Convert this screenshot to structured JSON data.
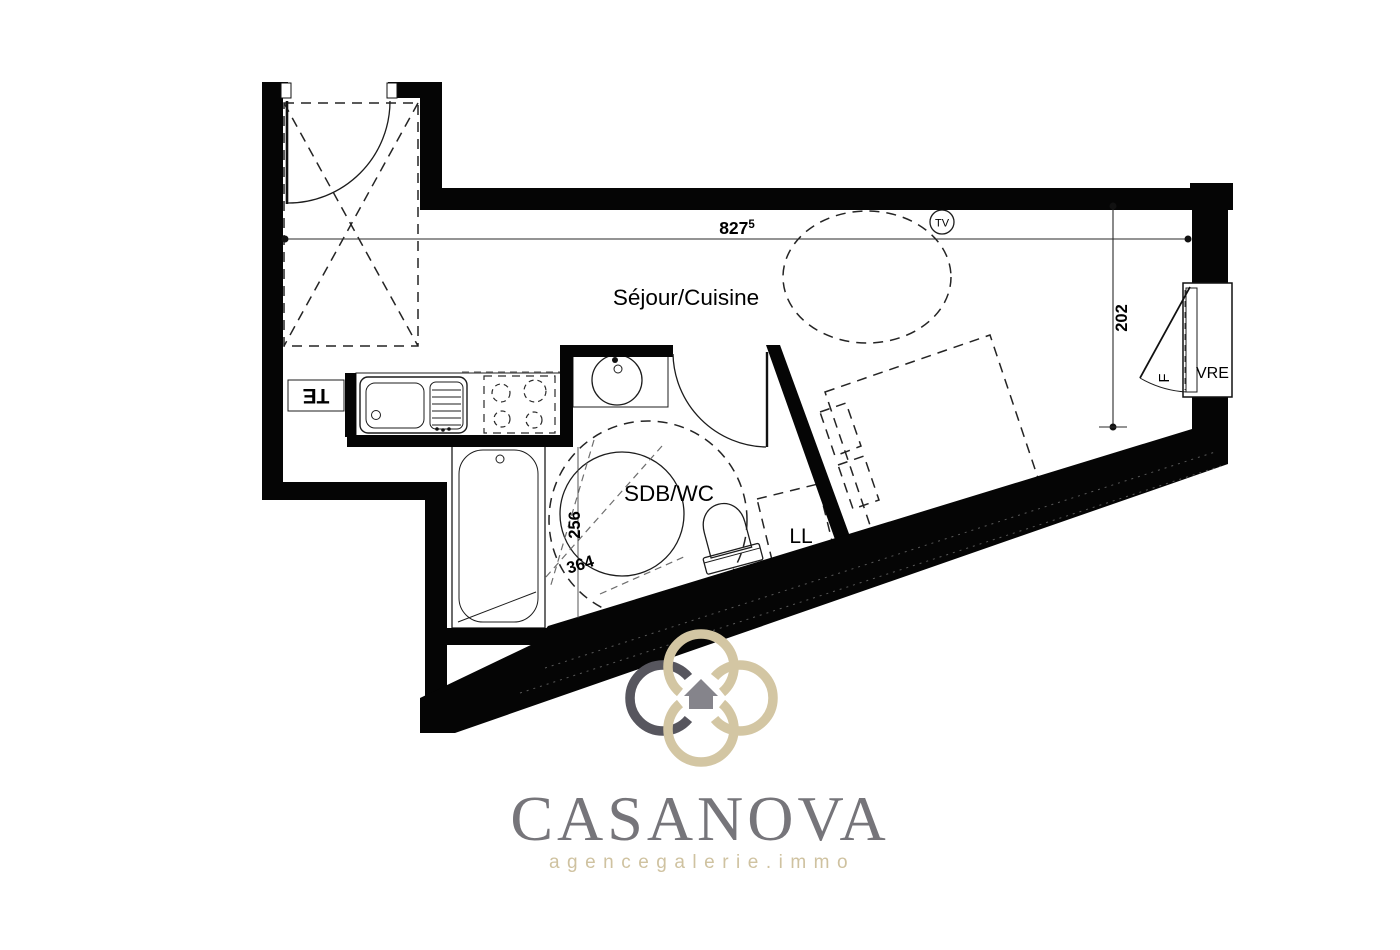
{
  "plan": {
    "room_labels": {
      "living_kitchen": "Séjour/Cuisine",
      "bathroom": "SDB/WC"
    },
    "fixture_labels": {
      "washing_machine": "LL",
      "tv": "TV",
      "window_leaf": "F",
      "window_tag": "VRE",
      "electrical_panel": "TE"
    },
    "dimensions": {
      "top_width": "827",
      "top_width_sup": "5",
      "right_depth": "202",
      "bathroom_width": "256",
      "bathroom_length": "364"
    }
  },
  "branding": {
    "agency_name": "CASANOVA",
    "tagline": "agencegalerie.immo",
    "colors": {
      "ring_dark": "#57565e",
      "ring_beige": "#d3c6a3",
      "house_gray": "#85848b",
      "name_gray": "#76757a",
      "tagline_beige": "#cfc2a0"
    }
  }
}
